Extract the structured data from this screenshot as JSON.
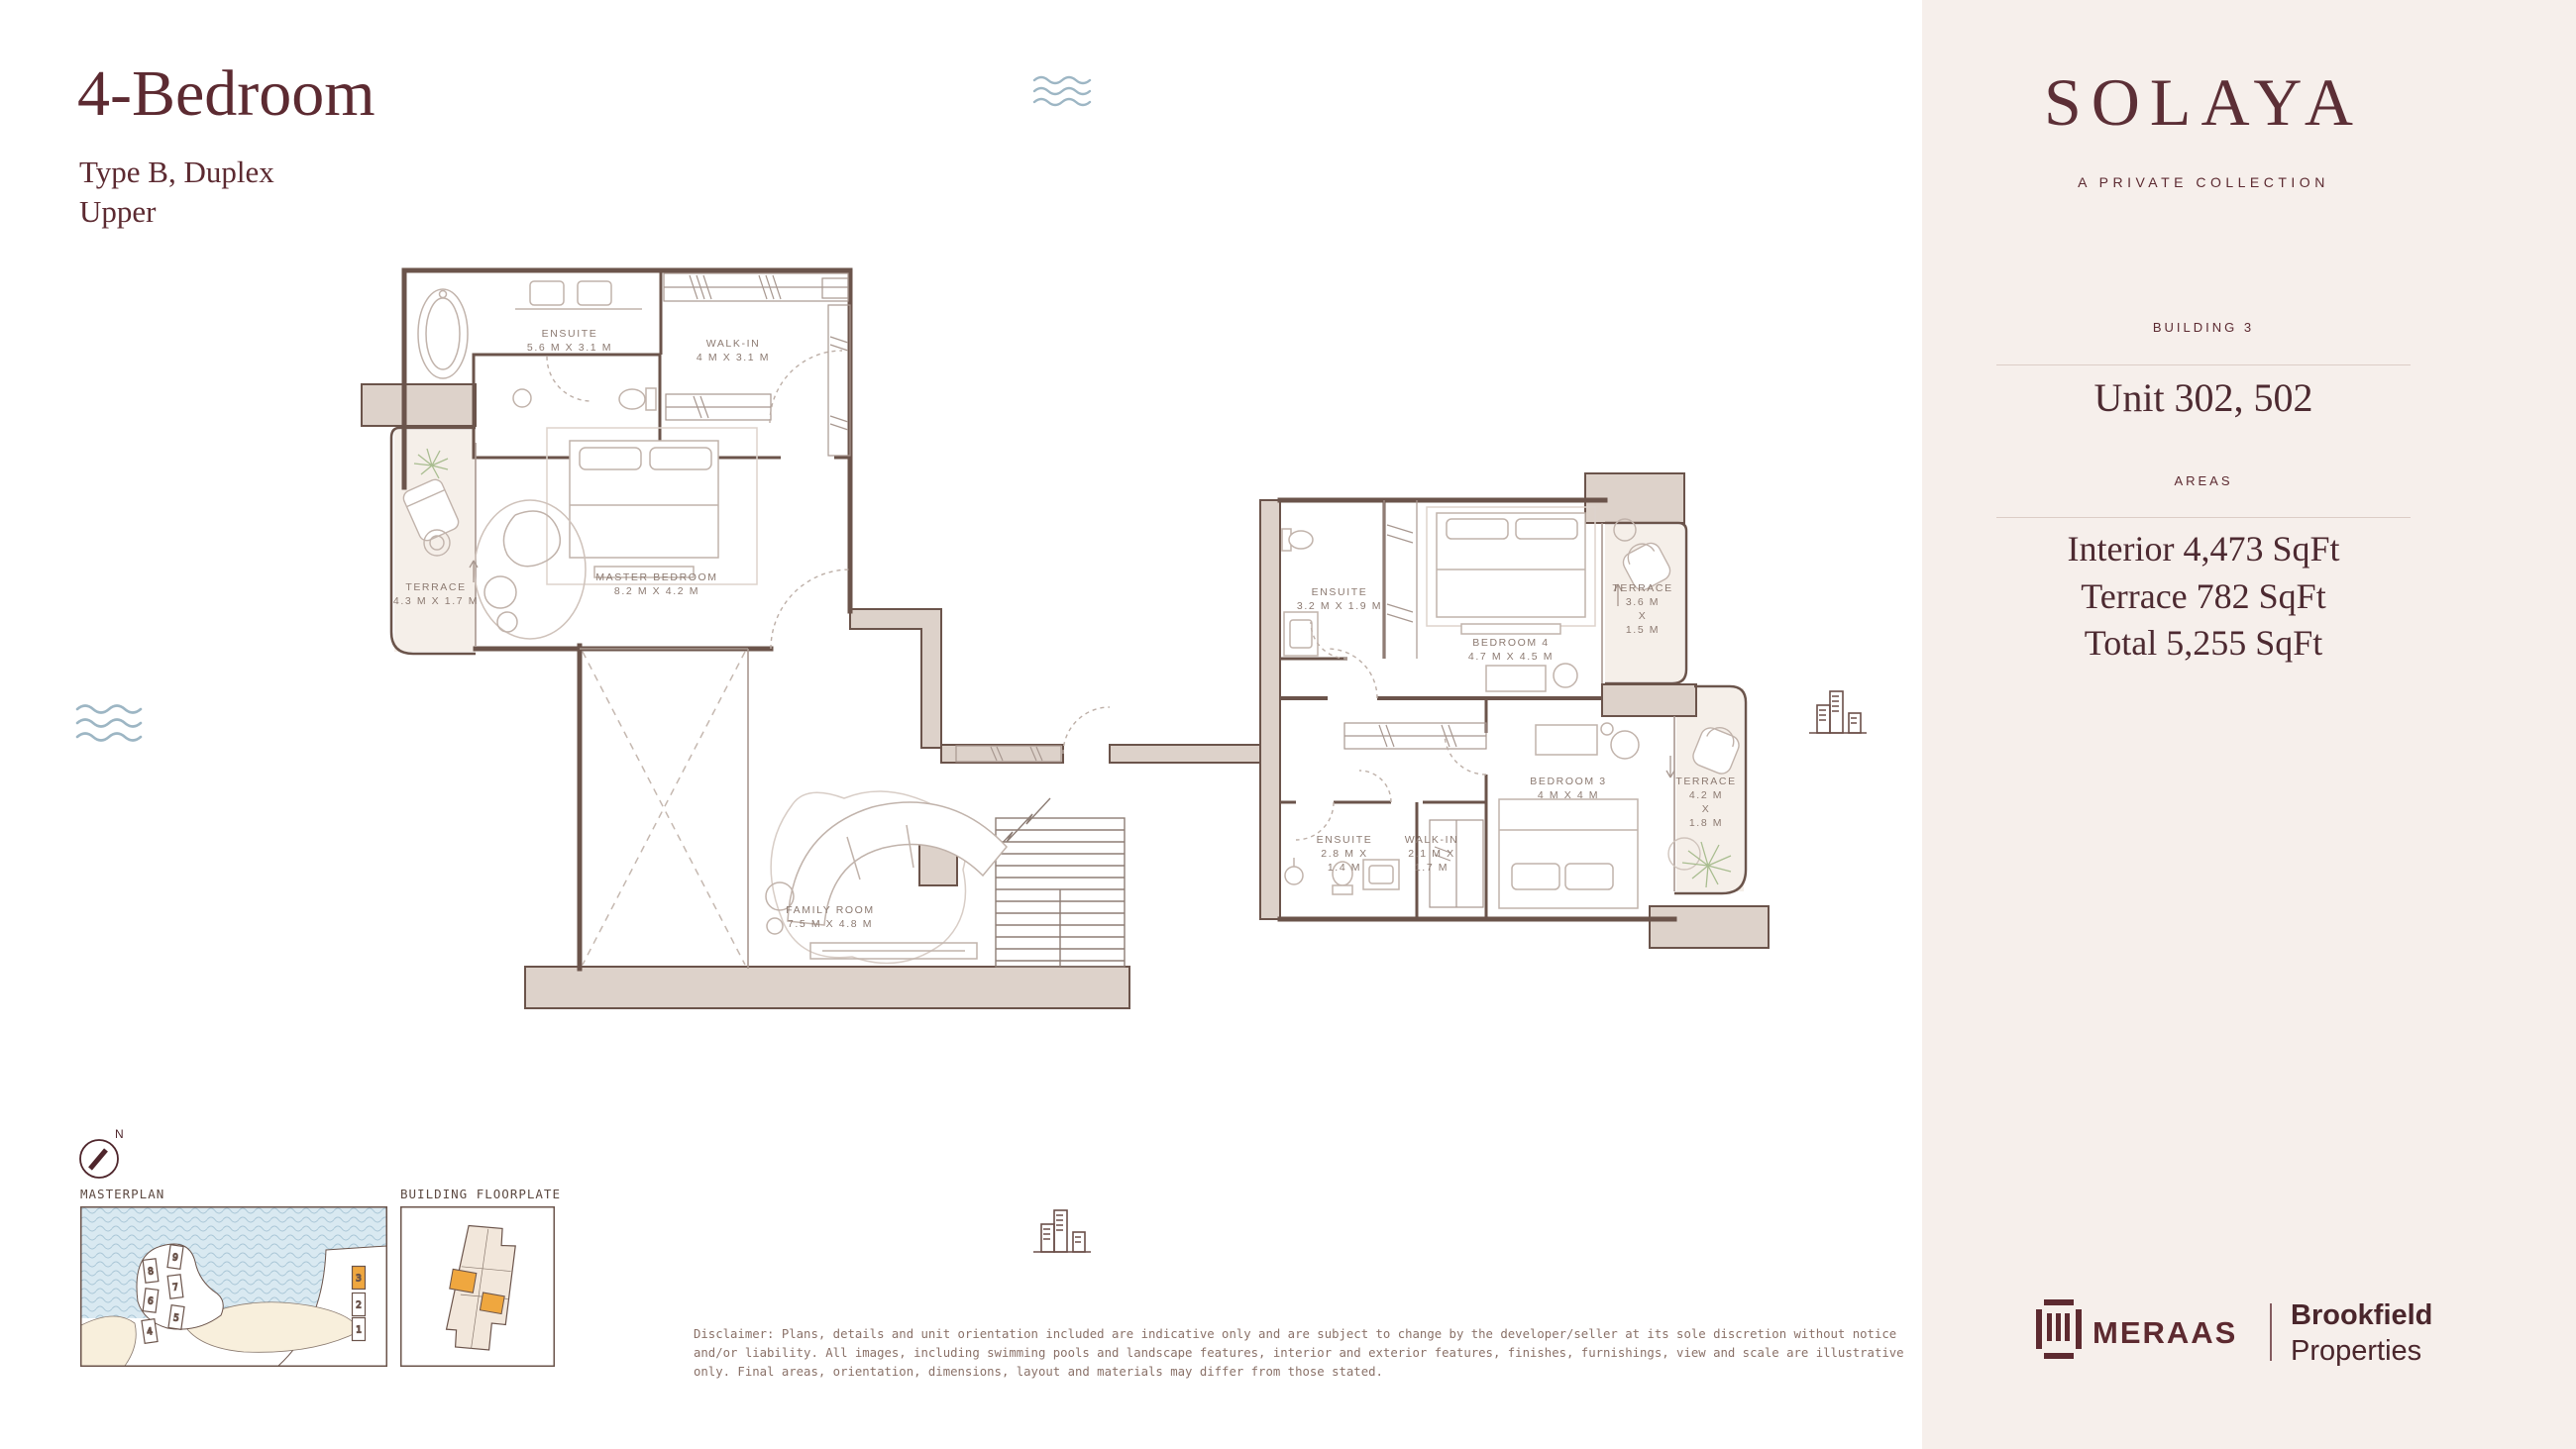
{
  "header": {
    "title": "4-Bedroom",
    "subtitle": "Type B, Duplex",
    "level": "Upper"
  },
  "sidebar": {
    "logo": "SOLAYA",
    "tagline": "A PRIVATE COLLECTION",
    "building": "BUILDING 3",
    "unit": "Unit 302, 502",
    "areas_heading": "AREAS",
    "area_lines": [
      "Interior 4,473 SqFt",
      "Terrace 782 SqFt",
      "Total 5,255 SqFt"
    ]
  },
  "floorplan": {
    "rooms": [
      {
        "name": "ensuite-master",
        "lines": [
          "ENSUITE",
          "5.6 M X 3.1 M"
        ]
      },
      {
        "name": "walk-in-master",
        "lines": [
          "WALK-IN",
          "4 M X 3.1 M"
        ]
      },
      {
        "name": "master-bedroom",
        "lines": [
          "MASTER BEDROOM",
          "8.2 M X 4.2 M"
        ]
      },
      {
        "name": "terrace-master",
        "lines": [
          "TERRACE",
          "4.3 M X 1.7 M"
        ]
      },
      {
        "name": "family-room",
        "lines": [
          "FAMILY ROOM",
          "7.5 M X 4.8 M"
        ]
      },
      {
        "name": "ensuite-bedroom4",
        "lines": [
          "ENSUITE",
          "3.2 M X 1.9 M"
        ]
      },
      {
        "name": "bedroom-4",
        "lines": [
          "BEDROOM 4",
          "4.7 M X 4.5 M"
        ]
      },
      {
        "name": "terrace-bedroom4",
        "lines": [
          "TERRACE",
          "3.6 M",
          "X",
          "1.5 M"
        ]
      },
      {
        "name": "bedroom-3",
        "lines": [
          "BEDROOM 3",
          "4 M X 4 M"
        ]
      },
      {
        "name": "terrace-bedroom3",
        "lines": [
          "TERRACE",
          "4.2 M",
          "X",
          "1.8 M"
        ]
      },
      {
        "name": "ensuite-bedroom3",
        "lines": [
          "ENSUITE",
          "2.8 M X",
          "1.4 M"
        ]
      },
      {
        "name": "walk-in-bedroom3",
        "lines": [
          "WALK-IN",
          "2.1 M X",
          "1.7 M"
        ]
      }
    ]
  },
  "thumbnails": {
    "compass_n": "N",
    "masterplan_label": "MASTERPLAN",
    "floorplate_label": "BUILDING FLOORPLATE",
    "masterplan_buildings": [
      {
        "label": "9"
      },
      {
        "label": "8"
      },
      {
        "label": "7"
      },
      {
        "label": "6"
      },
      {
        "label": "5"
      },
      {
        "label": "4"
      },
      {
        "label": "3",
        "highlighted": true
      },
      {
        "label": "2"
      },
      {
        "label": "1"
      }
    ]
  },
  "disclaimer": {
    "lines": [
      "Disclaimer: Plans, details and unit orientation included are indicative only and are subject to change by the developer/seller at its sole discretion without notice",
      "and/or liability. All images, including swimming pools and landscape features, interior and exterior features, finishes, furnishings, view and scale are illustrative",
      "only. Final areas, orientation, dimensions, layout and materials may differ from those stated."
    ]
  },
  "footer": {
    "meraas": "MERAAS",
    "brookfield": [
      "Brookfield",
      "Properties"
    ]
  },
  "colors": {
    "maroon": "#5c2a31",
    "wall": "#6b544b",
    "wall_fill": "#ddd2ca",
    "sidebar_bg": "#f6efeb",
    "highlight_orange": "#efa73f",
    "water": "#d9e9f1",
    "wave_icon": "#9db6c4",
    "sand": "#f8efdc",
    "room_label": "#8c7a71"
  }
}
